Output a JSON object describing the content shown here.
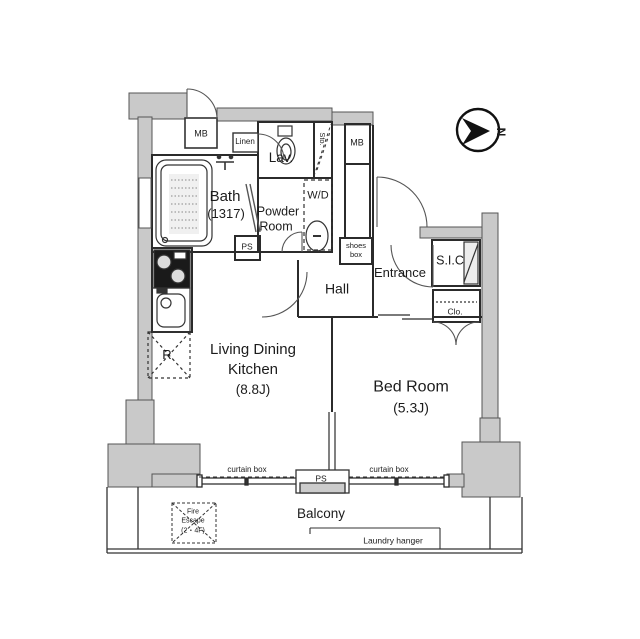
{
  "colors": {
    "wall_fill": "#c9c9c9",
    "line": "#2b2b2b",
    "background": "#ffffff"
  },
  "compass": {
    "north_label": "N"
  },
  "rooms": {
    "bath": {
      "name": "Bath",
      "size": "(1317)"
    },
    "powder_room": {
      "name_line1": "Powder",
      "name_line2": "Room"
    },
    "lavatory": {
      "name": "Lav."
    },
    "hall": {
      "name": "Hall"
    },
    "entrance": {
      "name": "Entrance"
    },
    "shoe_closet": {
      "name": "S.I.C"
    },
    "closet": {
      "name": "Clo."
    },
    "living_dining_kitchen": {
      "name_line1": "Living Dining",
      "name_line2": "Kitchen",
      "size": "(8.8J)"
    },
    "bedroom": {
      "name": "Bed Room",
      "size": "(5.3J)"
    },
    "balcony": {
      "name": "Balcony"
    }
  },
  "features": {
    "meter_box_left": "MB",
    "meter_box_right": "MB",
    "linen": "Linen",
    "storage": "Sto.",
    "washer_dryer": "W/D",
    "pipe_space_top": "PS",
    "pipe_space_bottom": "PS",
    "shoes_box_line1": "shoes",
    "shoes_box_line2": "box",
    "refrigerator": "R",
    "curtain_box_left": "curtain box",
    "curtain_box_right": "curtain box",
    "fire_escape_line1": "Fire",
    "fire_escape_line2": "Escape",
    "fire_escape_line3": "(2・4F)",
    "laundry_hanger": "Laundry hanger"
  }
}
